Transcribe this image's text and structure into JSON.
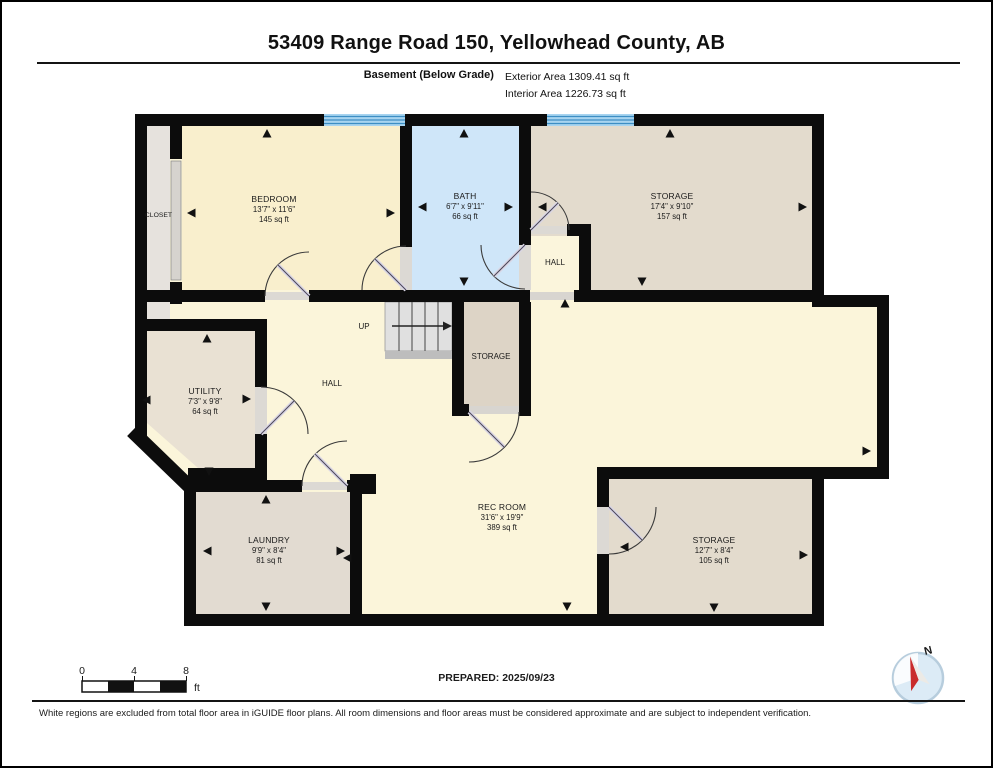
{
  "header": {
    "title": "53409 Range Road 150, Yellowhead County, AB",
    "floor_label": "Basement (Below Grade)",
    "exterior_area": "Exterior Area 1309.41 sq ft",
    "interior_area": "Interior Area 1226.73 sq ft"
  },
  "rooms": {
    "closet": {
      "name": "CLOSET"
    },
    "bedroom": {
      "name": "BEDROOM",
      "dims": "13'7\" x 11'6\"",
      "area": "145 sq ft"
    },
    "bath": {
      "name": "BATH",
      "dims": "6'7\" x 9'11\"",
      "area": "66 sq ft"
    },
    "hall_upper": {
      "name": "HALL"
    },
    "storage_top_right": {
      "name": "STORAGE",
      "dims": "17'4\" x 9'10\"",
      "area": "157 sq ft"
    },
    "stairs": {
      "name": "UP"
    },
    "storage_middle": {
      "name": "STORAGE"
    },
    "utility": {
      "name": "UTILITY",
      "dims": "7'3\" x 9'8\"",
      "area": "64 sq ft"
    },
    "hall_main": {
      "name": "HALL"
    },
    "laundry": {
      "name": "LAUNDRY",
      "dims": "9'9\" x 8'4\"",
      "area": "81 sq ft"
    },
    "rec_room": {
      "name": "REC ROOM",
      "dims": "31'6\" x 19'9\"",
      "area": "389 sq ft"
    },
    "storage_bottom_right": {
      "name": "STORAGE",
      "dims": "12'7\" x 8'4\"",
      "area": "105 sq ft"
    }
  },
  "footer": {
    "scale_ticks": [
      "0",
      "4",
      "8"
    ],
    "scale_unit": "ft",
    "prepared": "PREPARED: 2025/09/23",
    "compass_label": "N",
    "disclaimer": "White regions are excluded from total floor area in iGUIDE floor plans. All room dimensions and floor areas must be considered approximate and are subject to independent verification."
  },
  "colors": {
    "wall": "#0c0c0c",
    "hall_cream": "#fbf5da",
    "bedroom_cream": "#f9efcd",
    "bath_blue": "#cfe6f9",
    "window_blue": "#a8d4f0",
    "window_line": "#3d8ec4",
    "storage_tan": "#e3dbcd",
    "closet_gray": "#e6e2dd",
    "compass_red": "#c92b2b"
  }
}
